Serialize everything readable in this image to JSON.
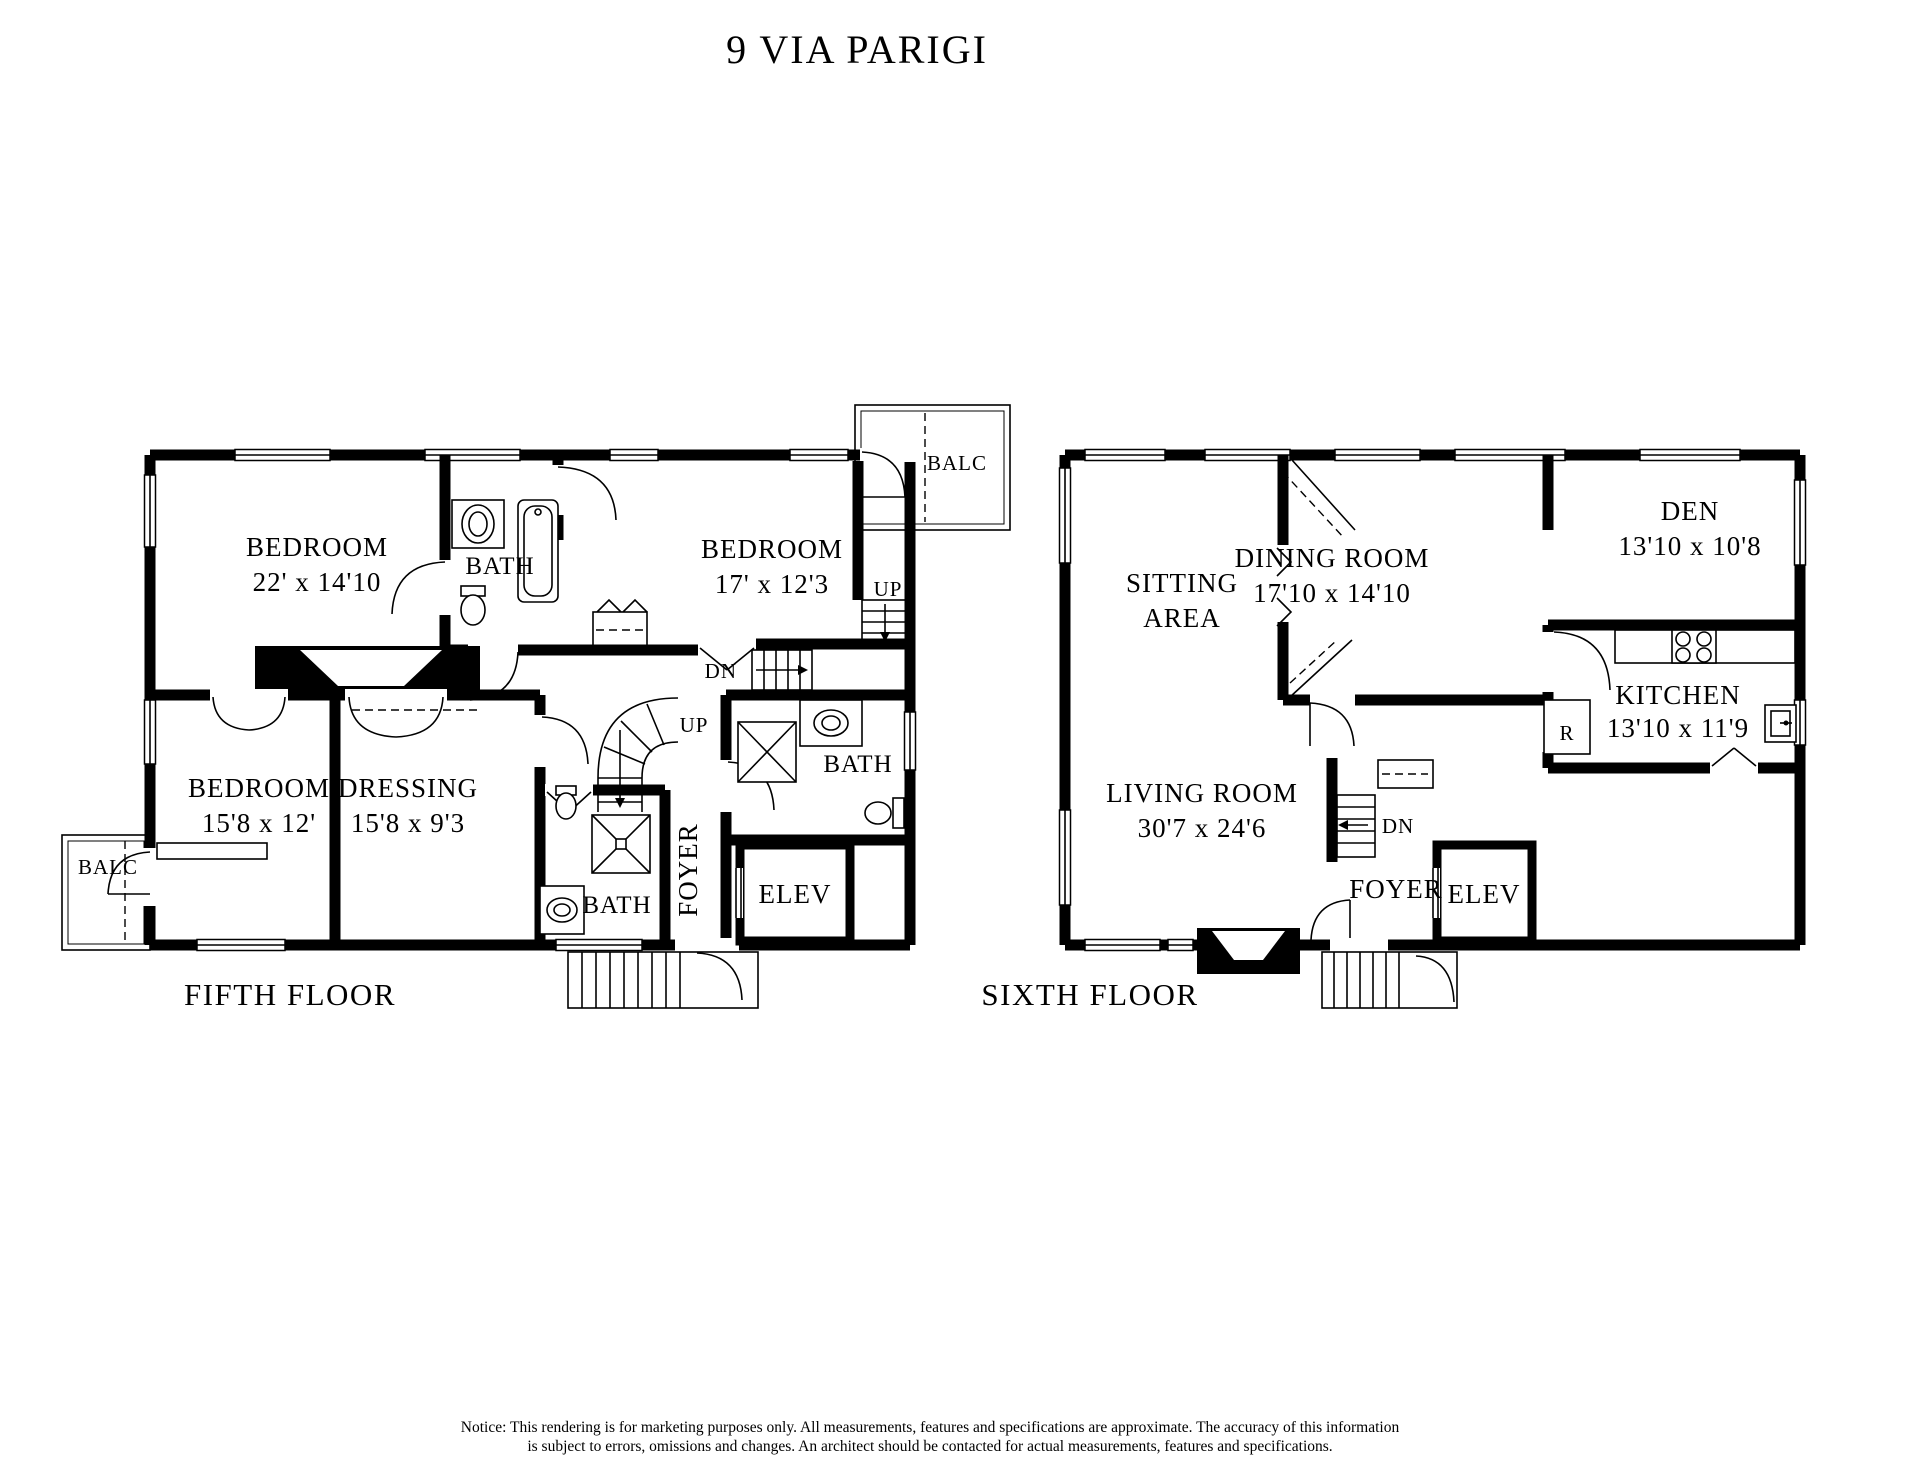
{
  "title": "9 VIA PARIGI",
  "fifth_floor": {
    "label": "FIFTH FLOOR",
    "rooms": {
      "bedroom_large": {
        "name": "BEDROOM",
        "dims": "22' x 14'10"
      },
      "bedroom_right": {
        "name": "BEDROOM",
        "dims": "17' x 12'3"
      },
      "bedroom_lower": {
        "name": "BEDROOM",
        "dims": "15'8 x 12'"
      },
      "dressing": {
        "name": "DRESSING",
        "dims": "15'8 x 9'3"
      },
      "bath_top": {
        "name": "BATH"
      },
      "bath_lower": {
        "name": "BATH"
      },
      "bath_right": {
        "name": "BATH"
      },
      "foyer": {
        "name": "FOYER"
      },
      "elevator": {
        "name": "ELEV"
      }
    },
    "balconies": {
      "right": "BALC",
      "left": "BALC"
    },
    "stairs": {
      "up_right": "UP",
      "up_center": "UP",
      "down_center": "DN"
    }
  },
  "sixth_floor": {
    "label": "SIXTH FLOOR",
    "rooms": {
      "sitting_area": {
        "line1": "SITTING",
        "line2": "AREA"
      },
      "dining_room": {
        "name": "DINING ROOM",
        "dims": "17'10 x 14'10"
      },
      "den": {
        "name": "DEN",
        "dims": "13'10 x 10'8"
      },
      "kitchen": {
        "name": "KITCHEN",
        "dims": "13'10 x 11'9"
      },
      "living_room": {
        "name": "LIVING ROOM",
        "dims": "30'7 x 24'6"
      },
      "foyer": {
        "name": "FOYER"
      },
      "elevator": {
        "name": "ELEV"
      }
    },
    "appliances": {
      "refrigerator": "R"
    },
    "stairs": {
      "down_center": "DN"
    }
  },
  "notice": {
    "line1": "Notice: This rendering is for marketing purposes only. All measurements, features and specifications are approximate. The accuracy of this information",
    "line2": "is subject to errors, omissions and changes. An architect should be contacted for actual measurements, features and specifications."
  }
}
